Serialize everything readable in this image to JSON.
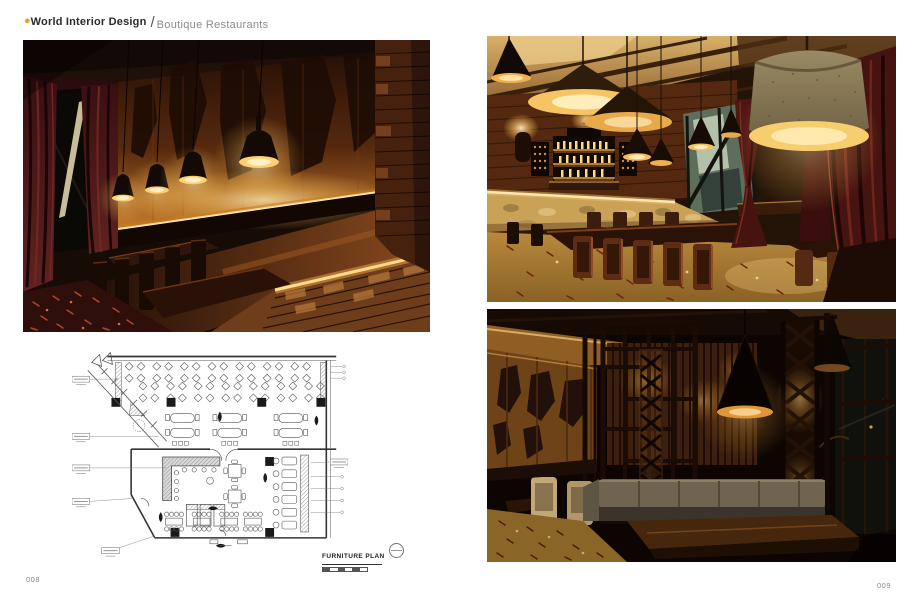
{
  "header": {
    "bullet": "●",
    "title": "World Interior Design",
    "separator": "/",
    "subtitle": "Boutique Restaurants"
  },
  "plan": {
    "title": "FURNITURE PLAN"
  },
  "footer": {
    "left_page_number": "008",
    "right_page_number": "009"
  },
  "photos": {
    "left_main": "restaurant-bar-carved-wood-wall-pendant-lamps",
    "right_top": "restaurant-dining-hall-bar-and-drum-lamp",
    "right_bottom": "dining-booth-with-lattice-screens-and-cone-lamp"
  },
  "colors": {
    "accent_bullet": "#e8a23c",
    "page_background": "#ffffff",
    "header_title": "#2b2b2b",
    "header_subtitle": "#8c8c8c",
    "page_number": "#8a8a8a",
    "warm_glow": "#f7c463",
    "dark_wood": "#2a130a",
    "curtain_maroon": "#4e1613",
    "plan_line": "#555555"
  }
}
